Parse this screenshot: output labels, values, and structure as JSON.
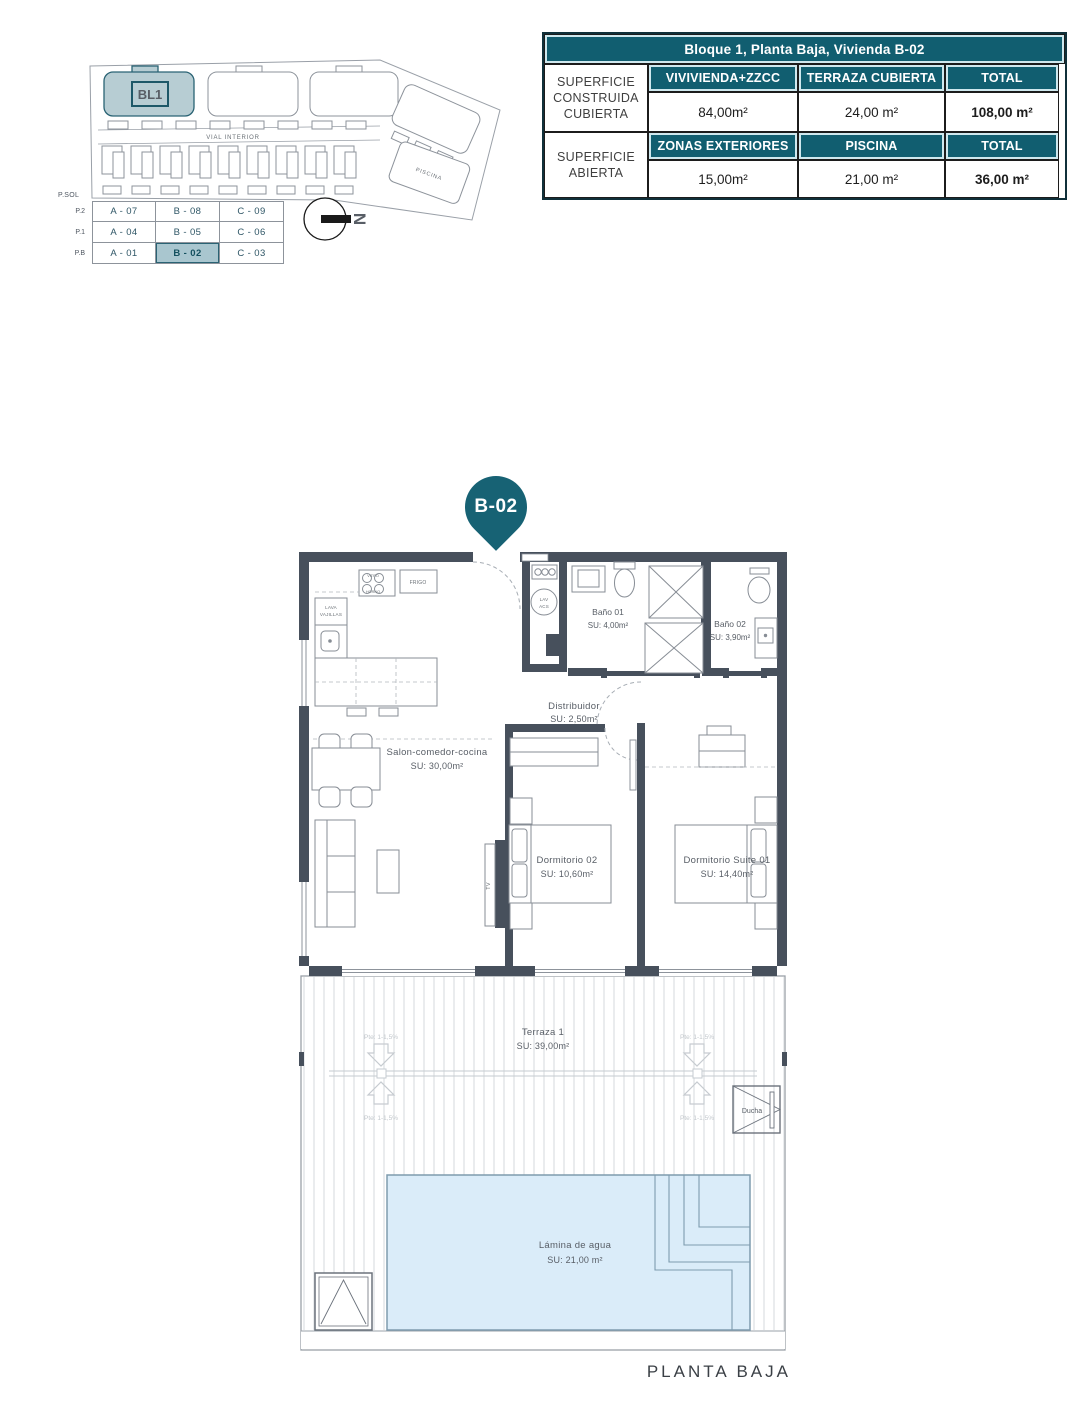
{
  "page": {
    "caption": "PLANTA BAJA"
  },
  "site_plan": {
    "block_label": "BL1",
    "road_label": "VIAL INTERIOR",
    "bottom_label": "CAMPO DE GOLF",
    "pool_label": "PISCINA",
    "north_label": "N"
  },
  "unit_matrix": {
    "header": "P.SOL",
    "levels": [
      "P.2",
      "P.1",
      "P.B"
    ],
    "rows": [
      [
        "A - 07",
        "B - 08",
        "C - 09"
      ],
      [
        "A - 04",
        "B - 05",
        "C - 06"
      ],
      [
        "A - 01",
        "B - 02",
        "C - 03"
      ]
    ],
    "highlighted": "B - 02"
  },
  "surface_table": {
    "title": "Bloque 1, Planta Baja, Vivienda B-02",
    "groups": [
      {
        "label": "SUPERFICIE CONSTRUIDA CUBIERTA",
        "columns": [
          "VIVIVIENDA+ZZCC",
          "TERRAZA CUBIERTA",
          "TOTAL"
        ],
        "values": [
          "84,00m²",
          "24,00 m²",
          "108,00 m²"
        ]
      },
      {
        "label": "SUPERFICIE ABIERTA",
        "columns": [
          "ZONAS EXTERIORES",
          "PISCINA",
          "TOTAL"
        ],
        "values": [
          "15,00m²",
          "21,00 m²",
          "36,00 m²"
        ]
      }
    ]
  },
  "floor_plan": {
    "pin": "B-02",
    "rooms": {
      "salon": {
        "name": "Salon-comedor-cocina",
        "su": "SU: 30,00m²"
      },
      "bano1": {
        "name": "Baño 01",
        "su": "SU: 4,00m²"
      },
      "bano2": {
        "name": "Baño 02",
        "su": "SU: 3,90m²"
      },
      "distribuidor": {
        "name": "Distribuidor",
        "su": "SU: 2,50m²"
      },
      "dorm2": {
        "name": "Dormitorio 02",
        "su": "SU: 10,60m²"
      },
      "suite": {
        "name": "Dormitorio Suite 01",
        "su": "SU: 14,40m²"
      },
      "terraza": {
        "name": "Terraza 1",
        "su": "SU: 39,00m²"
      },
      "pool": {
        "name": "Lámina de agua",
        "su": "SU: 21,00 m²"
      }
    },
    "fixtures": {
      "frigo": "FRIGO",
      "vitro": "VITRO",
      "horno": "HORNO",
      "lava": "LAVA",
      "vajillas": "VAJILLAS",
      "lav": "LAV",
      "acs": "ACS",
      "tv": "TV",
      "ducha": "Ducha",
      "slope": "Pte: 1-1,5%"
    }
  },
  "colors": {
    "teal": "#115e70",
    "wall": "#47505c",
    "pool_fill": "#daecf9",
    "highlight": "#a9c6cf"
  }
}
